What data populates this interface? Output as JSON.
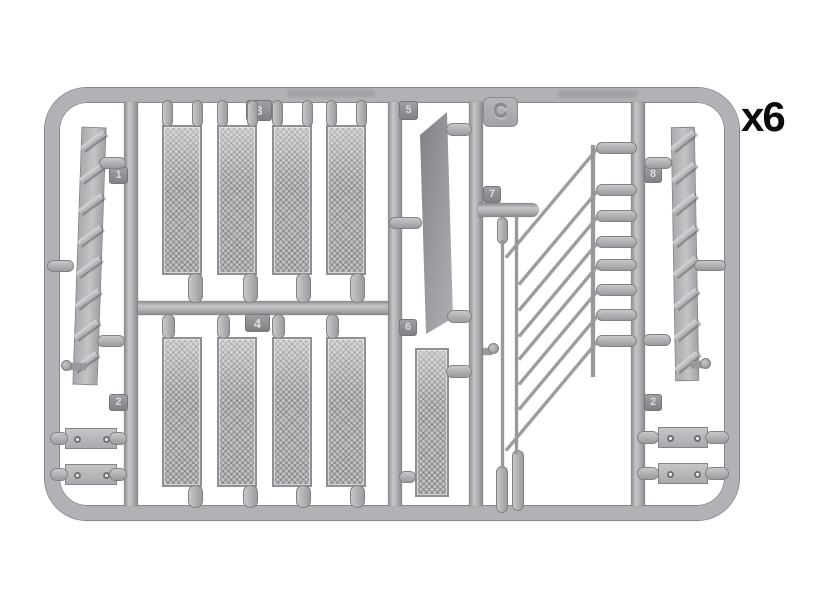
{
  "figure": {
    "type": "model-kit-sprue-diagram",
    "plate_letter": "C",
    "quantity_label": "x6",
    "tabs": {
      "t1": "1",
      "t2_left": "2",
      "t3": "3",
      "t4": "4",
      "t5": "5",
      "t6": "6",
      "t7": "7",
      "t8": "8",
      "t2_right": "2",
      "plate": "C"
    },
    "colors": {
      "background": "#ffffff",
      "plastic": "#b0b2b5",
      "plastic_dark": "#85878a",
      "plastic_light": "#c6c8ca",
      "tab_text": "#d8dadc",
      "annotation_text": "#0c0c0c"
    }
  }
}
